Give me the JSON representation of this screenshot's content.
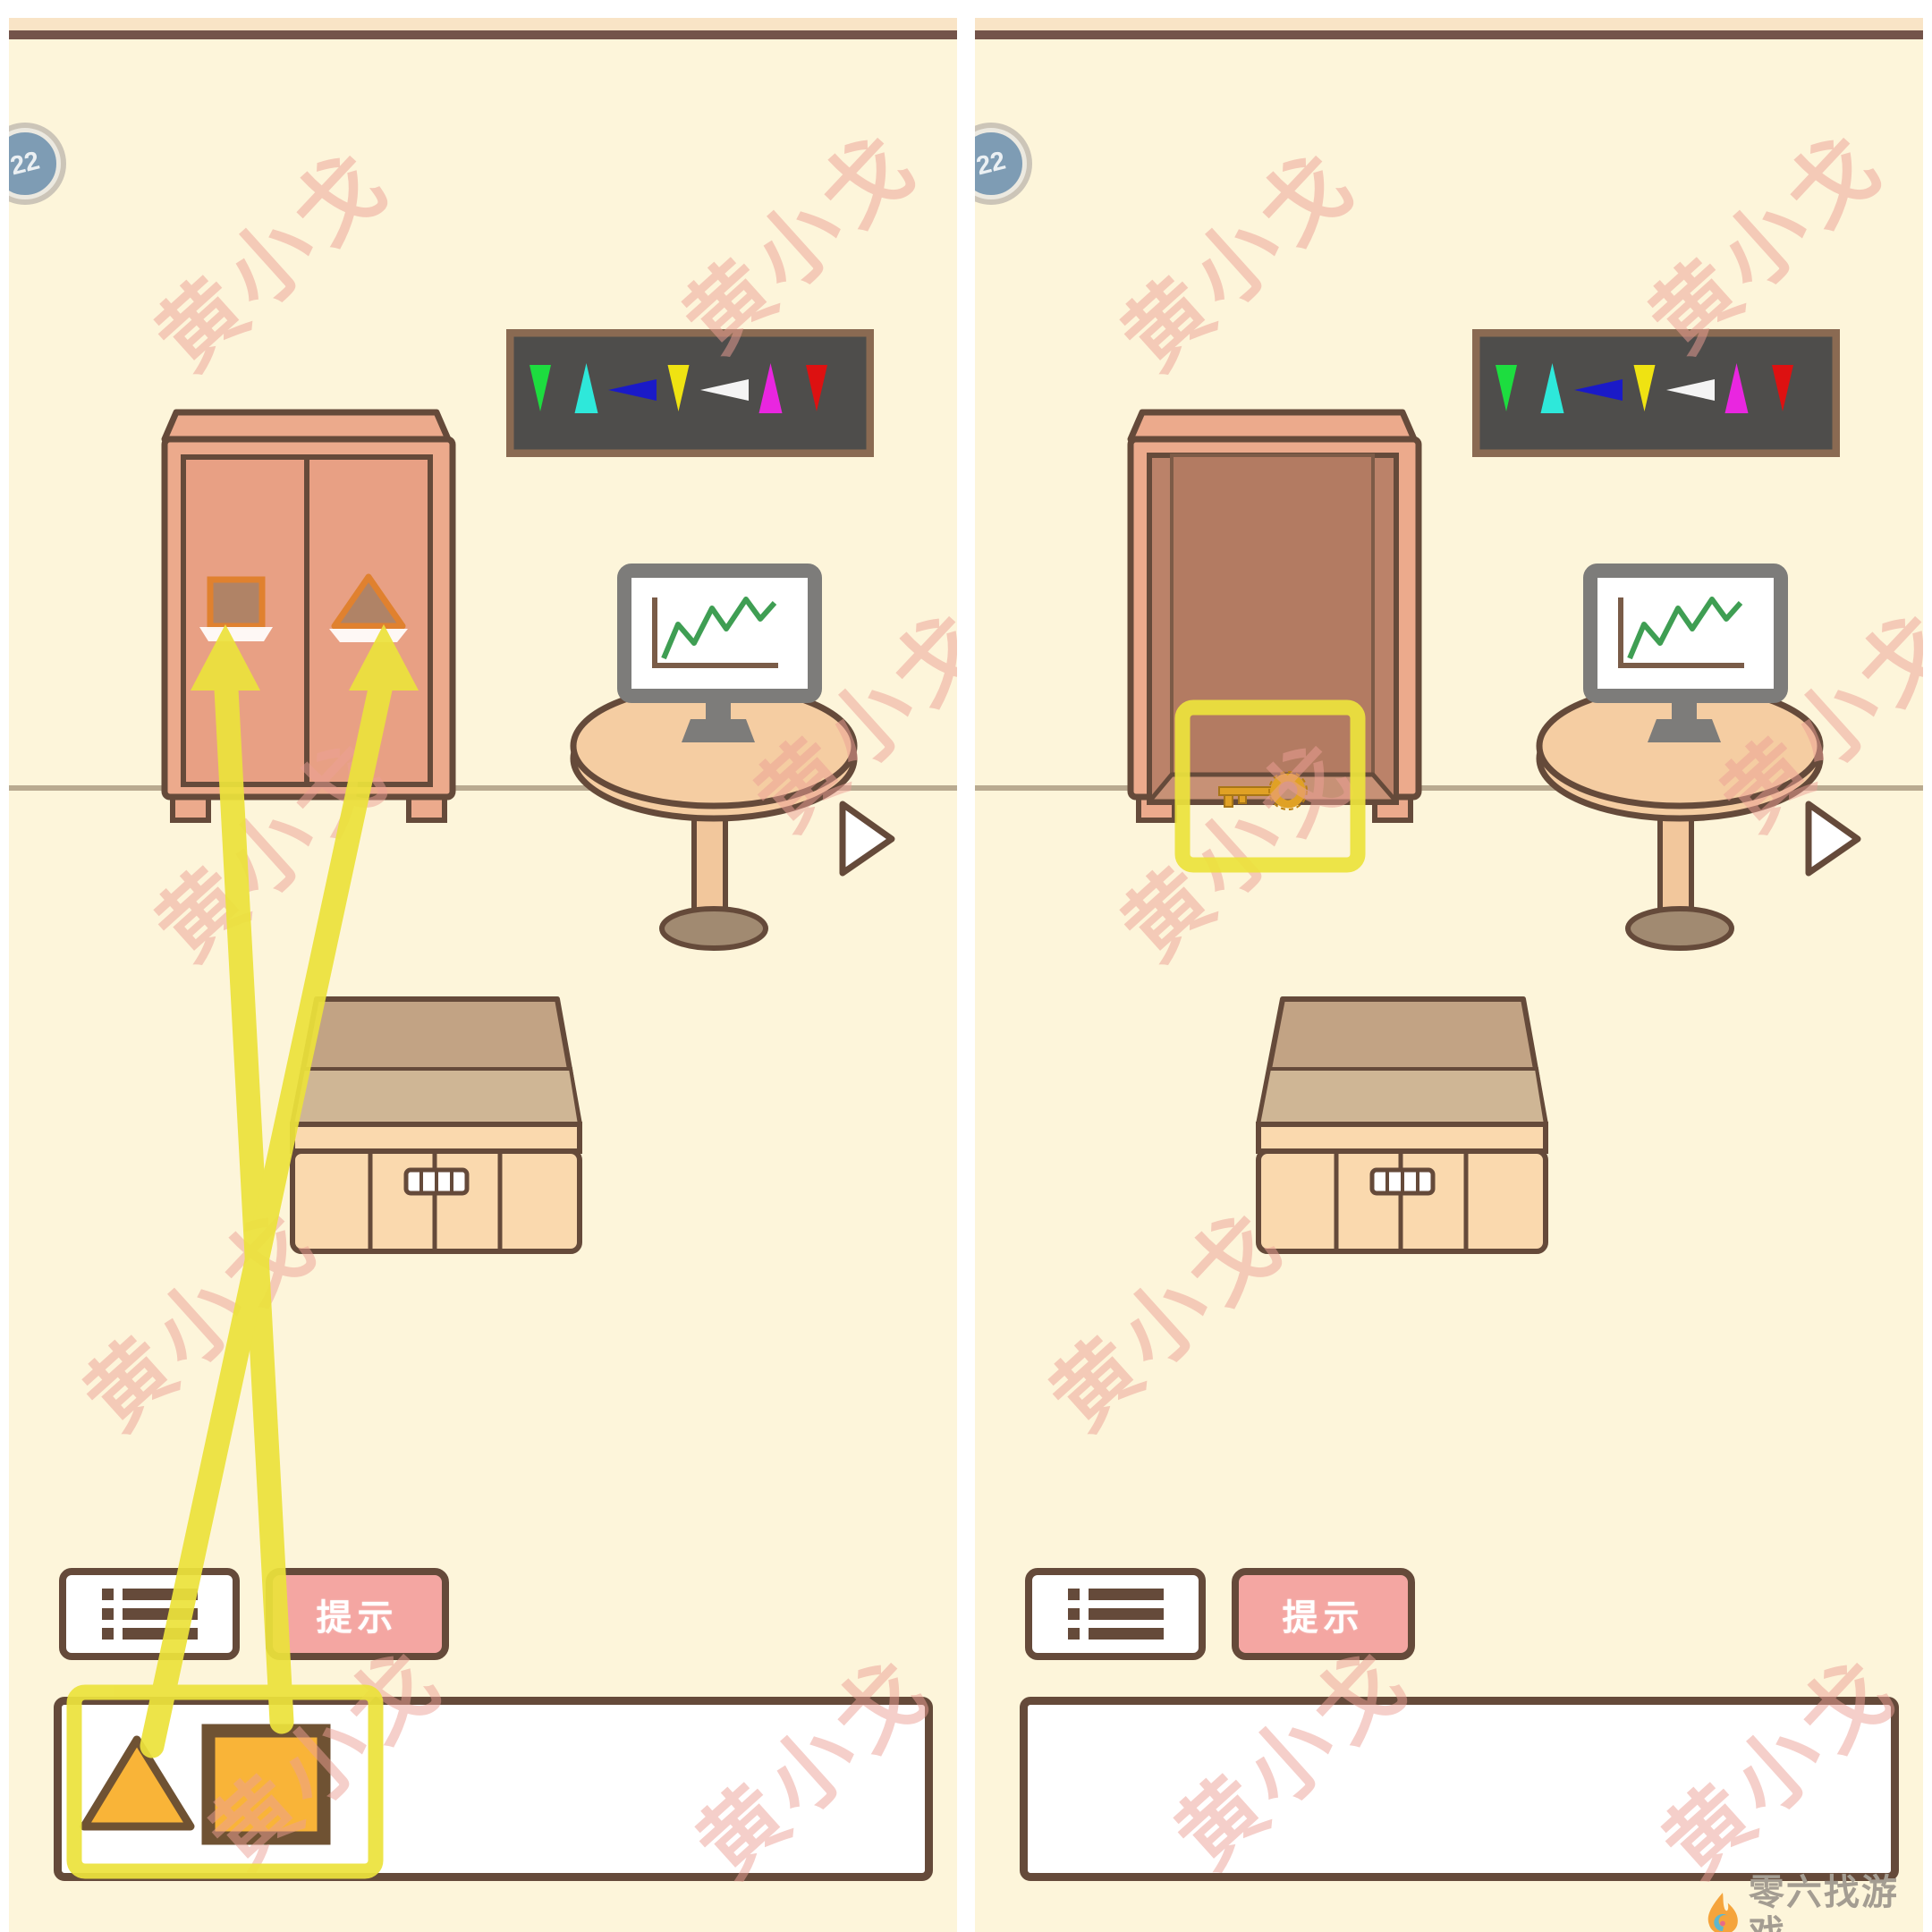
{
  "colors": {
    "cream": "#fdf5da",
    "strip": "#f9e4c6",
    "line_brown": "#74544a",
    "outline": "#654a3a",
    "salmon": "#ecaa8c",
    "door": "#e8a084",
    "hole_fill": "#b08366",
    "hole_orange": "#e0812f",
    "interior": "#bb8269",
    "interior_back": "#b37b62",
    "interior_floor": "#c79176",
    "box_back": "#c2a384",
    "box_floor": "#cfb695",
    "box_front": "#fad9ae",
    "table": "#f5cda2",
    "table_leg": "#f2c79c",
    "table_base": "#a18a71",
    "monitor_gray": "#7d7c7a",
    "chart_green": "#3f9e53",
    "banner_bg": "#4e4d4b",
    "banner_border": "#8a6a52",
    "yellow": "#ece23c",
    "item_orange": "#f9b438",
    "item_stroke": "#6f5233",
    "pink": "#f4a6a2",
    "wm_pink": "#eda096",
    "key_gold": "#e0a125",
    "floor_line": "#b9aa90",
    "badge_blue": "#7e9cb4",
    "badge_ring": "#ccc5b8",
    "logo_gray": "#a49d92"
  },
  "level_badge": "22",
  "watermark": {
    "text": "黄小戈"
  },
  "banner": {
    "shapes": [
      {
        "name": "green-down-cone-icon",
        "dir": "down",
        "color": "#1ddd3f"
      },
      {
        "name": "cyan-up-cone-icon",
        "dir": "up",
        "color": "#2ee8da"
      },
      {
        "name": "blue-left-cone-icon",
        "dir": "left",
        "color": "#1a1ac8"
      },
      {
        "name": "yellow-down-cone-icon",
        "dir": "down",
        "color": "#efe312"
      },
      {
        "name": "white-left-cone-icon",
        "dir": "left",
        "color": "#f4f4f4"
      },
      {
        "name": "magenta-up-cone-icon",
        "dir": "up",
        "color": "#e926e0"
      },
      {
        "name": "red-down-cone-icon",
        "dir": "down",
        "color": "#dd1111"
      }
    ]
  },
  "panels": {
    "left": {
      "hint_button": "提示",
      "wardrobe": {
        "state": "closed",
        "left_door_hole": "square",
        "right_door_hole": "triangle"
      },
      "inventory_items": [
        {
          "name": "triangle-tile"
        },
        {
          "name": "square-tile"
        }
      ],
      "annotations": {
        "arrow_1": "square-tile-to-left-door-hole",
        "arrow_2": "triangle-tile-to-right-door-hole",
        "highlight": "inventory-items"
      }
    },
    "right": {
      "hint_button": "提示",
      "wardrobe": {
        "state": "open",
        "contents": "golden-key"
      },
      "inventory_items": [],
      "annotations": {
        "highlight": "key-inside-wardrobe"
      }
    }
  },
  "footer_logo": {
    "title": "零六找游戏",
    "url_left": "www.lingliuyx.com",
    "url_right": "www.06zyx.com"
  }
}
